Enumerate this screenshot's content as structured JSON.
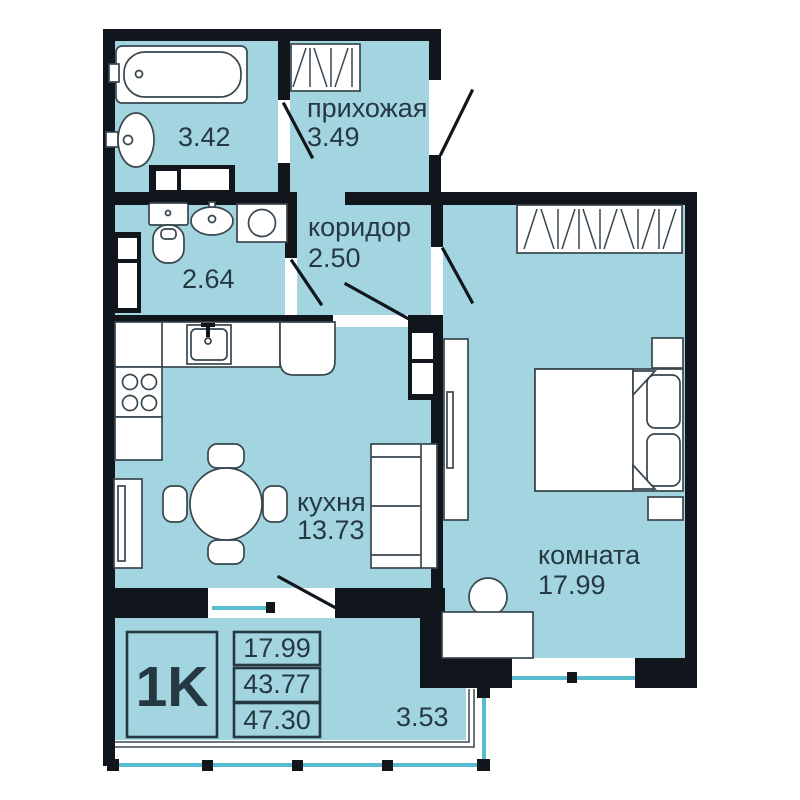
{
  "summary": {
    "type_label": "1K",
    "living_area": "17.99",
    "apartment_area": "43.77",
    "total_area": "47.30"
  },
  "rooms": {
    "bathroom": {
      "area": "3.42"
    },
    "hallway": {
      "label": "прихожая",
      "area": "3.49"
    },
    "toilet": {
      "area": "2.64"
    },
    "corridor": {
      "label": "коридор",
      "area": "2.50"
    },
    "kitchen": {
      "label": "кухня",
      "area": "13.73"
    },
    "living_room": {
      "label": "комната",
      "area": "17.99"
    },
    "balcony": {
      "area": "3.53"
    }
  },
  "colors": {
    "floor": "#a3d5e0",
    "walls": "#10161c",
    "glazing": "#58bcd0",
    "text": "#263942",
    "furniture_outline": "#38464e",
    "background": "#ffffff"
  }
}
